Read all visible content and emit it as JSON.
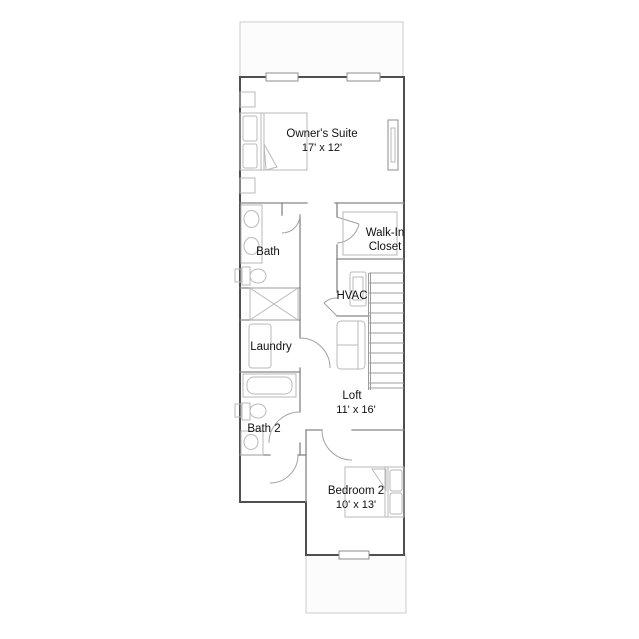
{
  "plan": {
    "rooms": {
      "owners_suite": {
        "name": "Owner's Suite",
        "dims": "17' x 12'"
      },
      "bath": {
        "name": "Bath"
      },
      "walk_in_closet": {
        "line1": "Walk-In",
        "line2": "Closet"
      },
      "hvac": {
        "name": "HVAC"
      },
      "laundry": {
        "name": "Laundry"
      },
      "loft": {
        "name": "Loft",
        "dims": "11' x 16'"
      },
      "bath_2": {
        "name": "Bath 2"
      },
      "bedroom_2": {
        "name": "Bedroom 2",
        "dims": "10' x 13'"
      }
    }
  },
  "colors": {
    "wall-ext": "#4f4f4f",
    "wall-int": "#868686",
    "fixture": "#b9b9b9",
    "door": "#a2a2a2",
    "stair": "#9c9c9c",
    "area-stroke": "#cccccc",
    "area-fill": "#fcfcfc",
    "window-stroke": "#8d8d8d",
    "text": "#111111",
    "background": "#ffffff"
  }
}
